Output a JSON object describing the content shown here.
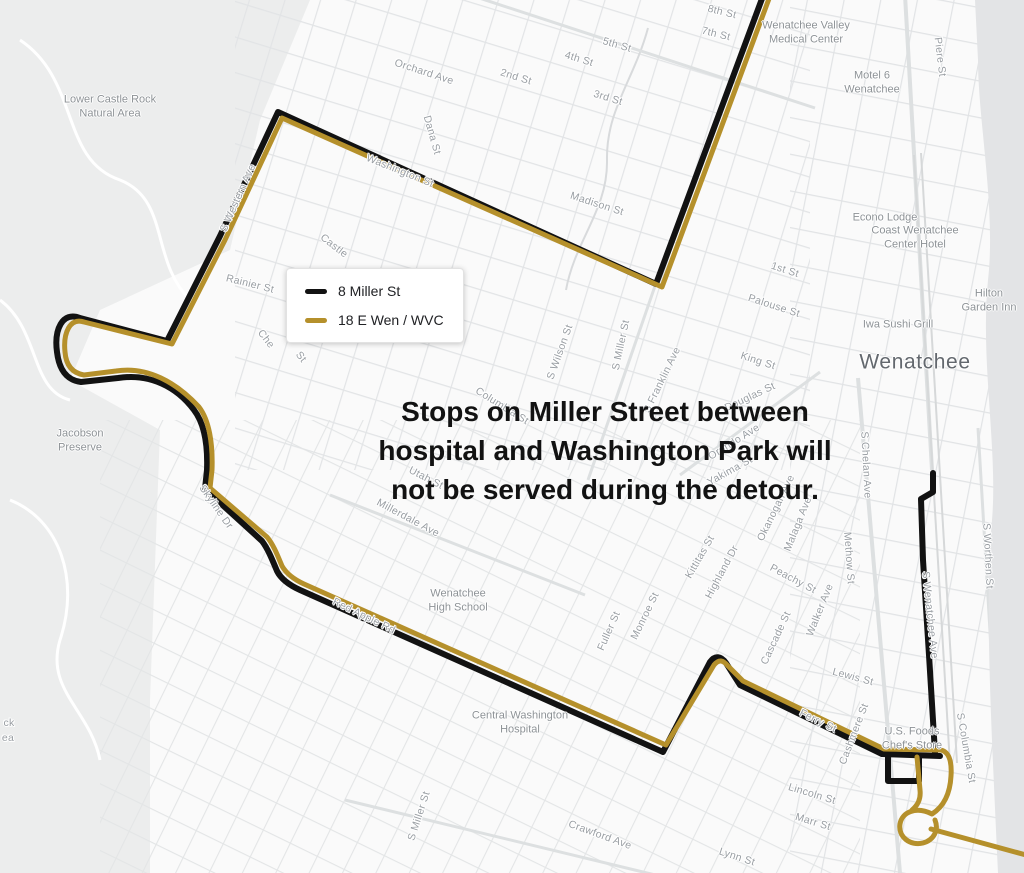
{
  "legend": {
    "items": [
      {
        "label": "8 Miller St",
        "color": "#121212"
      },
      {
        "label": "18 E Wen / WVC",
        "color": "#b5902b"
      }
    ]
  },
  "annotation": {
    "lines": [
      "Stops on Miller Street between",
      "hospital and Washington Park will",
      "not be served during the detour."
    ]
  },
  "map": {
    "city_label": {
      "text": "Wenatchee",
      "x": 915,
      "y": 362
    },
    "street_labels": [
      {
        "t": "8th St",
        "x": 722,
        "y": 12,
        "r": 14
      },
      {
        "t": "7th St",
        "x": 716,
        "y": 34,
        "r": 14
      },
      {
        "t": "5th St",
        "x": 617,
        "y": 45,
        "r": 16
      },
      {
        "t": "4th St",
        "x": 579,
        "y": 59,
        "r": 17
      },
      {
        "t": "2nd St",
        "x": 516,
        "y": 77,
        "r": 17
      },
      {
        "t": "3rd St",
        "x": 608,
        "y": 98,
        "r": 17
      },
      {
        "t": "Orchard Ave",
        "x": 424,
        "y": 72,
        "r": 18
      },
      {
        "t": "Dana St",
        "x": 432,
        "y": 135,
        "r": 74
      },
      {
        "t": "Washington St",
        "x": 400,
        "y": 171,
        "r": 22
      },
      {
        "t": "Madison St",
        "x": 597,
        "y": 204,
        "r": 18
      },
      {
        "t": "Piere St",
        "x": 940,
        "y": 57,
        "r": 83
      },
      {
        "t": "1st St",
        "x": 785,
        "y": 270,
        "r": 18
      },
      {
        "t": "Palouse St",
        "x": 774,
        "y": 306,
        "r": 18
      },
      {
        "t": "King St",
        "x": 758,
        "y": 361,
        "r": 18
      },
      {
        "t": "Castle",
        "x": 334,
        "y": 246,
        "r": 38
      },
      {
        "t": "Rainier St",
        "x": 250,
        "y": 284,
        "r": 14
      },
      {
        "t": "Che",
        "x": 266,
        "y": 339,
        "r": 52
      },
      {
        "t": "St",
        "x": 301,
        "y": 357,
        "r": 52
      },
      {
        "t": "S Western Ave",
        "x": 238,
        "y": 198,
        "r": -66
      },
      {
        "t": "S Wilson St",
        "x": 560,
        "y": 352,
        "r": -70
      },
      {
        "t": "S Miller St",
        "x": 621,
        "y": 345,
        "r": -78
      },
      {
        "t": "S Franklin Ave",
        "x": 662,
        "y": 380,
        "r": -64
      },
      {
        "t": "Columbia St",
        "x": 502,
        "y": 406,
        "r": 32
      },
      {
        "t": "Utah St",
        "x": 426,
        "y": 478,
        "r": 27
      },
      {
        "t": "Millerdale Ave",
        "x": 408,
        "y": 518,
        "r": 28
      },
      {
        "t": "Skyline Dr",
        "x": 216,
        "y": 507,
        "r": 55
      },
      {
        "t": "Red Apple Rd",
        "x": 364,
        "y": 616,
        "r": 26
      },
      {
        "t": "Douglas St",
        "x": 750,
        "y": 397,
        "r": -25
      },
      {
        "t": "Orondo Ave",
        "x": 734,
        "y": 442,
        "r": -32
      },
      {
        "t": "Yakima St",
        "x": 730,
        "y": 471,
        "r": -29
      },
      {
        "t": "Okanogan Ave",
        "x": 776,
        "y": 508,
        "r": -64
      },
      {
        "t": "Malaga Ave",
        "x": 798,
        "y": 524,
        "r": -68
      },
      {
        "t": "Kittitas St",
        "x": 700,
        "y": 557,
        "r": -60
      },
      {
        "t": "Highland Dr",
        "x": 722,
        "y": 572,
        "r": -62
      },
      {
        "t": "Peachy St",
        "x": 793,
        "y": 579,
        "r": 28
      },
      {
        "t": "Methow St",
        "x": 849,
        "y": 558,
        "r": 86
      },
      {
        "t": "Walker Ave",
        "x": 820,
        "y": 610,
        "r": -68
      },
      {
        "t": "Cascade St",
        "x": 776,
        "y": 638,
        "r": -65
      },
      {
        "t": "Monroe St",
        "x": 645,
        "y": 616,
        "r": -64
      },
      {
        "t": "Fuller St",
        "x": 609,
        "y": 631,
        "r": -66
      },
      {
        "t": "Lewis St",
        "x": 853,
        "y": 677,
        "r": 15
      },
      {
        "t": "Ferry St",
        "x": 818,
        "y": 721,
        "r": 26
      },
      {
        "t": "Cashmere St",
        "x": 854,
        "y": 734,
        "r": -69
      },
      {
        "t": "S Columbia St",
        "x": 966,
        "y": 748,
        "r": 80
      },
      {
        "t": "S Chelan Ave",
        "x": 866,
        "y": 465,
        "r": 87
      },
      {
        "t": "S Wenatchee Ave",
        "x": 930,
        "y": 615,
        "r": 84
      },
      {
        "t": "S Worthen St",
        "x": 988,
        "y": 556,
        "r": 87
      },
      {
        "t": "S Miller St",
        "x": 419,
        "y": 816,
        "r": -72
      },
      {
        "t": "Crawford Ave",
        "x": 600,
        "y": 835,
        "r": 20
      },
      {
        "t": "Lincoln St",
        "x": 812,
        "y": 794,
        "r": 17
      },
      {
        "t": "Marr St",
        "x": 813,
        "y": 822,
        "r": 17
      },
      {
        "t": "Lynn St",
        "x": 737,
        "y": 857,
        "r": 18
      },
      {
        "t": "ck",
        "x": 9,
        "y": 723,
        "r": 0
      },
      {
        "t": "ea",
        "x": 8,
        "y": 738,
        "r": 0
      }
    ],
    "poi_labels": [
      {
        "lines": [
          "Lower Castle Rock",
          "Natural Area"
        ],
        "x": 110,
        "y": 107
      },
      {
        "lines": [
          "Jacobson",
          "Preserve"
        ],
        "x": 80,
        "y": 441
      },
      {
        "lines": [
          "Wenatchee Valley",
          "Medical Center"
        ],
        "x": 806,
        "y": 33
      },
      {
        "lines": [
          "Motel 6",
          "Wenatchee"
        ],
        "x": 872,
        "y": 83
      },
      {
        "lines": [
          "Econo Lodge"
        ],
        "x": 885,
        "y": 218
      },
      {
        "lines": [
          "Coast Wenatchee",
          "Center Hotel"
        ],
        "x": 915,
        "y": 238
      },
      {
        "lines": [
          "Hilton",
          "Garden Inn"
        ],
        "x": 989,
        "y": 301
      },
      {
        "lines": [
          "Iwa Sushi Grill"
        ],
        "x": 898,
        "y": 325
      },
      {
        "lines": [
          "Wenatchee",
          "High School"
        ],
        "x": 458,
        "y": 601
      },
      {
        "lines": [
          "Central Washington",
          "Hospital"
        ],
        "x": 520,
        "y": 723
      },
      {
        "lines": [
          "U.S. Foods",
          "Chef's Store"
        ],
        "x": 912,
        "y": 739
      }
    ],
    "routes": [
      {
        "id": "8-miller-st",
        "name": "8 Miller St",
        "color": "#121212",
        "width": 6,
        "paths": [
          "M 763,-4 L 656,284 L 278,112 L 220,236 L 167,341 L 80,318 C 62,311 54,330 57,352 C 59,369 66,380 81,382 L 118,378 C 150,373 177,387 194,410 C 204,423 208,443 207,470 L 205,489 L 262,541 C 268,549 272,559 277,571 C 281,579 289,585 300,590 L 663,752 L 710,662 C 715,655 721,656 726,663 L 740,685 L 882,754 L 940,756",
          "M 888,756 L 888,781 L 919,781 L 919,757",
          "M 933,473 L 933,492 L 921,499 L 923,560 L 929,655 L 935,753"
        ]
      },
      {
        "id": "18-e-wen-wvc",
        "name": "18 E Wen / WVC",
        "color": "#b5902b",
        "width": 5,
        "paths": [
          "M 770,-4 L 662,287 L 282,118 L 225,240 L 172,344 L 84,322 C 70,317 63,333 65,352 C 66,365 72,373 84,375 L 116,371 C 147,366 176,382 199,407 C 209,420 213,443 212,470 L 210,488 L 267,537 C 273,544 277,554 282,566 C 286,573 293,579 304,584 L 666,745 L 714,665 C 719,659 723,660 728,666 L 743,681 L 884,749 L 941,750 C 949,752 952,761 951,776 C 950,795 943,807 932,814 C 916,806 902,812 900,824 C 898,837 910,846 923,843 C 934,840 939,830 935,820",
          "M 917,757 L 920,790 C 921,799 918,805 912,810",
          "M 931,829 L 1026,855"
        ]
      }
    ]
  }
}
